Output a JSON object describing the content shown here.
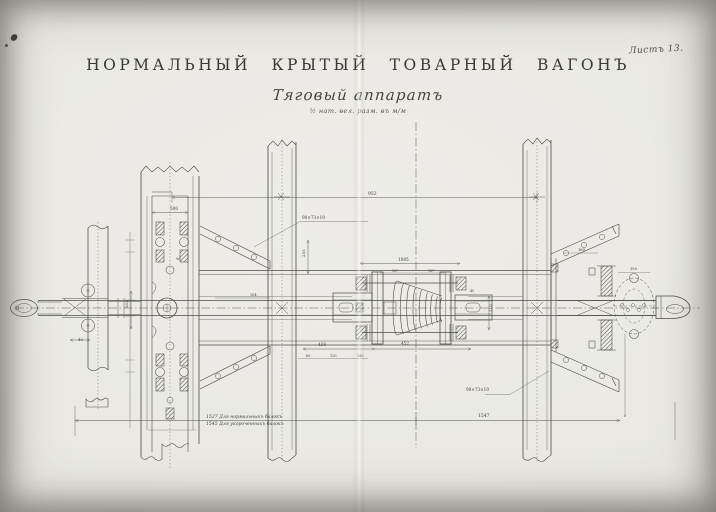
{
  "page": {
    "sheet_label": "Листъ 13."
  },
  "title_block": {
    "title": "НОРМАЛЬНЫЙ КРЫТЫЙ ТОВАРНЫЙ ВАГОНЪ",
    "subtitle": "Тяговый аппаратъ",
    "scale_note": "½ нат. вел. разм. въ м/м"
  },
  "drawing": {
    "subject": "draft-gear-plan-view",
    "colors": {
      "ink": "#4c4c48",
      "paper": "#e9e8e3"
    },
    "bottom_dimension": {
      "note_line1": "1527  Для нормальныхъ балокъ",
      "note_line2": "1545  Для укороченныхъ балокъ"
    },
    "dimension_labels": [
      {
        "text": "952",
        "x": 368,
        "y": 195,
        "size": 4.5
      },
      {
        "text": "1085",
        "x": 398,
        "y": 261,
        "size": 4.2
      },
      {
        "text": "438",
        "x": 318,
        "y": 346,
        "size": 4.2
      },
      {
        "text": "452",
        "x": 401,
        "y": 345,
        "size": 4.2
      },
      {
        "text": "500",
        "x": 170,
        "y": 210,
        "size": 4.2
      },
      {
        "text": "90×73×10",
        "x": 302,
        "y": 219,
        "size": 4.2
      },
      {
        "text": "90×73×10",
        "x": 466,
        "y": 391,
        "size": 4.2
      },
      {
        "text": "1547",
        "x": 478,
        "y": 417,
        "size": 4.5
      },
      {
        "text": "40",
        "x": 78,
        "y": 341,
        "size": 4
      },
      {
        "text": "202",
        "x": 128,
        "y": 308,
        "size": 4,
        "rotate": -90
      },
      {
        "text": "210",
        "x": 492,
        "y": 312,
        "size": 4,
        "rotate": -90
      },
      {
        "text": "255",
        "x": 305,
        "y": 257,
        "size": 4,
        "rotate": -90
      },
      {
        "text": "150",
        "x": 630,
        "y": 270,
        "size": 3.6
      },
      {
        "text": "160",
        "x": 578,
        "y": 251,
        "size": 3.6
      },
      {
        "text": "104",
        "x": 250,
        "y": 296,
        "size": 3.4
      },
      {
        "text": "65",
        "x": 306,
        "y": 357,
        "size": 3.4
      },
      {
        "text": "120",
        "x": 330,
        "y": 357,
        "size": 3.4
      },
      {
        "text": "140",
        "x": 357,
        "y": 357,
        "size": 3.4
      },
      {
        "text": "90",
        "x": 176,
        "y": 260,
        "size": 3.4
      },
      {
        "text": "45",
        "x": 470,
        "y": 292,
        "size": 3.2
      },
      {
        "text": "187",
        "x": 392,
        "y": 272,
        "size": 3.2
      },
      {
        "text": "187",
        "x": 428,
        "y": 272,
        "size": 3.2
      }
    ]
  }
}
